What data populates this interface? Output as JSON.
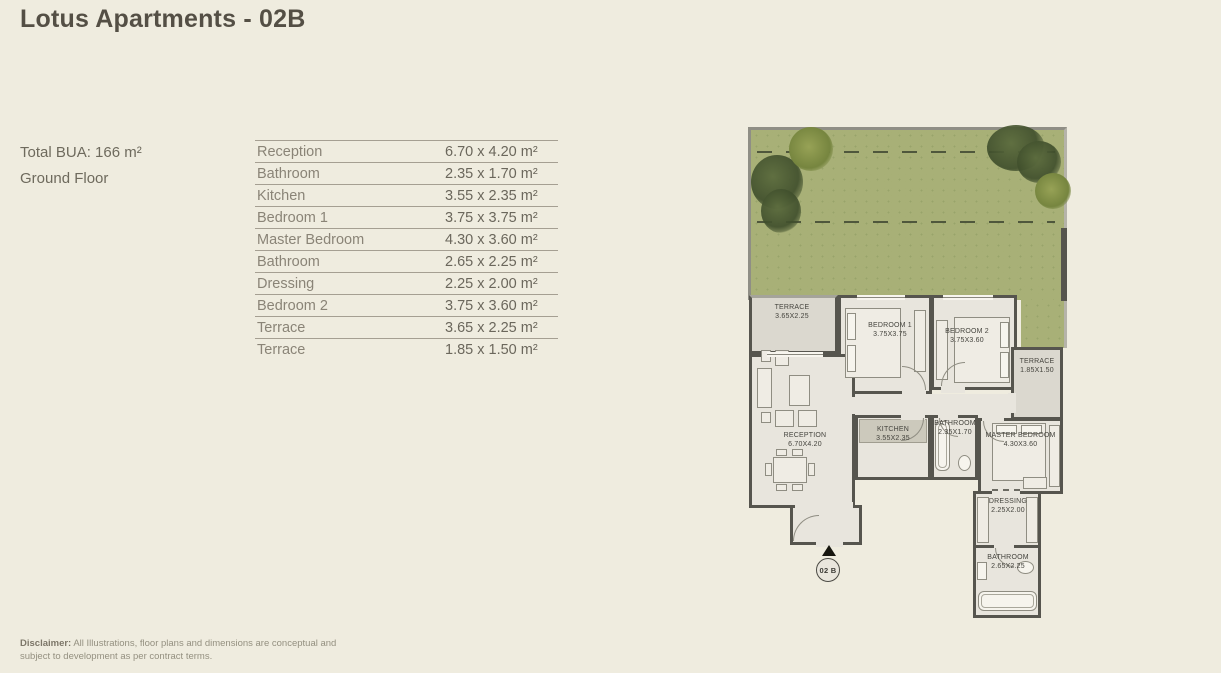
{
  "page": {
    "title": "Lotus Apartments - 02B",
    "total_bua": "Total BUA: 166 m²",
    "floor": "Ground Floor",
    "disclaimer_label": "Disclaimer:",
    "disclaimer_text": " All Illustrations, floor plans and dimensions are conceptual and subject to development as per contract terms."
  },
  "dimensions_table": {
    "rows": [
      {
        "room": "Reception",
        "size": "6.70 x 4.20 m²"
      },
      {
        "room": "Bathroom",
        "size": "2.35 x 1.70 m²"
      },
      {
        "room": "Kitchen",
        "size": "3.55 x 2.35 m²"
      },
      {
        "room": "Bedroom 1",
        "size": "3.75 x 3.75 m²"
      },
      {
        "room": "Master Bedroom",
        "size": "4.30 x 3.60 m²"
      },
      {
        "room": "Bathroom",
        "size": "2.65 x 2.25 m²"
      },
      {
        "room": "Dressing",
        "size": "2.25 x 2.00 m²"
      },
      {
        "room": "Bedroom 2",
        "size": "3.75 x 3.60 m²"
      },
      {
        "room": "Terrace",
        "size": "3.65 x 2.25 m²"
      },
      {
        "room": "Terrace",
        "size": "1.85 x 1.50 m²"
      }
    ]
  },
  "floor_plan": {
    "unit_label": "02 B",
    "rooms": [
      {
        "name": "TERRACE",
        "dims": "3.65X2.25"
      },
      {
        "name": "BEDROOM 1",
        "dims": "3.75X3.75"
      },
      {
        "name": "BEDROOM 2",
        "dims": "3.75X3.60"
      },
      {
        "name": "TERRACE",
        "dims": "1.85X1.50"
      },
      {
        "name": "RECEPTION",
        "dims": "6.70X4.20"
      },
      {
        "name": "KITCHEN",
        "dims": "3.55X2.35"
      },
      {
        "name": "BATHROOM",
        "dims": "2.35X1.70"
      },
      {
        "name": "MASTER BEDROOM",
        "dims": "4.30X3.60"
      },
      {
        "name": "DRESSING",
        "dims": "2.25X2.00"
      },
      {
        "name": "BATHROOM",
        "dims": "2.65X2.25"
      }
    ]
  },
  "colors": {
    "page_background": "#efecdf",
    "title_text": "#544f45",
    "table_text": "#8a8477",
    "wall": "#56554e",
    "floor": "#e8e5dd",
    "terrace_floor": "#dbd8cf",
    "garden_green": "#a8b077",
    "tree_green": "#55663d"
  }
}
